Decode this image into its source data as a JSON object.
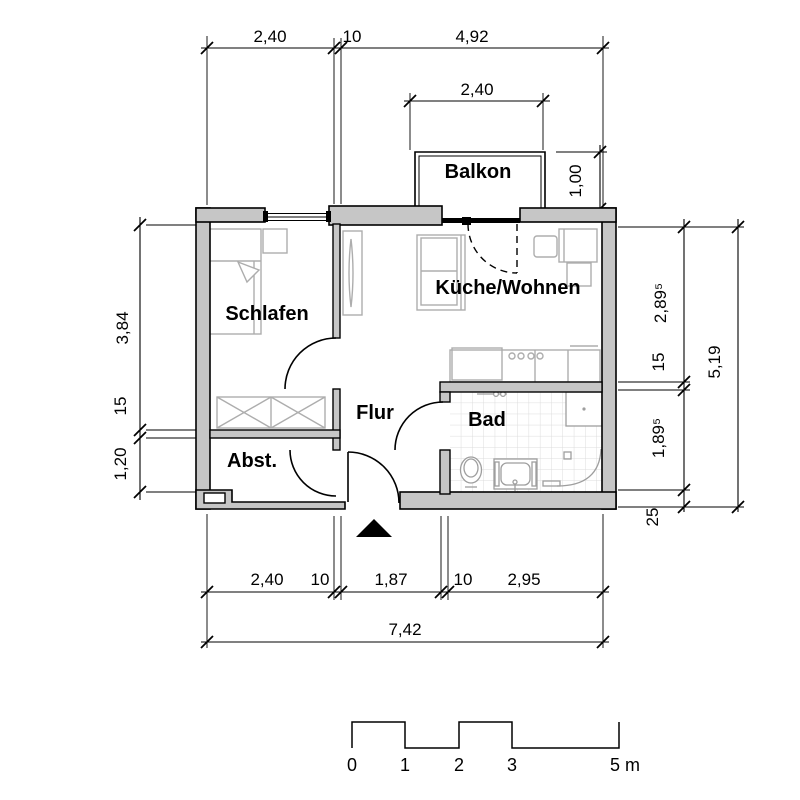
{
  "labels": {
    "balkon": "Balkon",
    "schlafen": "Schlafen",
    "kueche": "Küche/Wohnen",
    "flur": "Flur",
    "bad": "Bad",
    "abst": "Abst."
  },
  "dims": {
    "top": [
      "2,40",
      "10",
      "4,92"
    ],
    "balcony_width": "2,40",
    "balcony_depth": "1,00",
    "left": [
      "3,84",
      "15",
      "1,20"
    ],
    "right": [
      "2,89⁵",
      "15",
      "1,89⁵",
      "25"
    ],
    "right_total": "5,19",
    "bottom": [
      "2,40",
      "10",
      "1,87",
      "10",
      "2,95"
    ],
    "bottom_total": "7,42"
  },
  "scale": {
    "labels": [
      "0",
      "1",
      "2",
      "3",
      "5 m"
    ]
  }
}
